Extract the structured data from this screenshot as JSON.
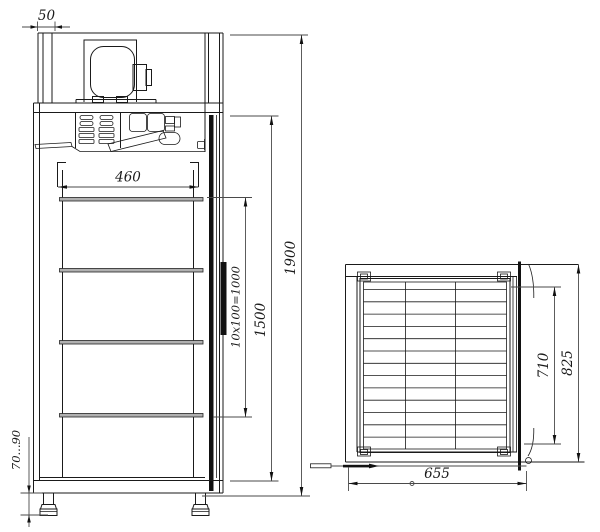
{
  "drawing": {
    "front_view": {
      "top_panel_offset": "50",
      "interior_width": "460",
      "overall_height": "1900",
      "interior_height": "1500",
      "shelf_pitch": "10x100=1000",
      "leg_height_range": "70...90"
    },
    "plan_view": {
      "overall_width": "655",
      "interior_depth": "710",
      "overall_depth": "825"
    },
    "colors": {
      "line": "#1a1a1a",
      "dimension": "#4a4a4a",
      "background": "#ffffff"
    }
  }
}
